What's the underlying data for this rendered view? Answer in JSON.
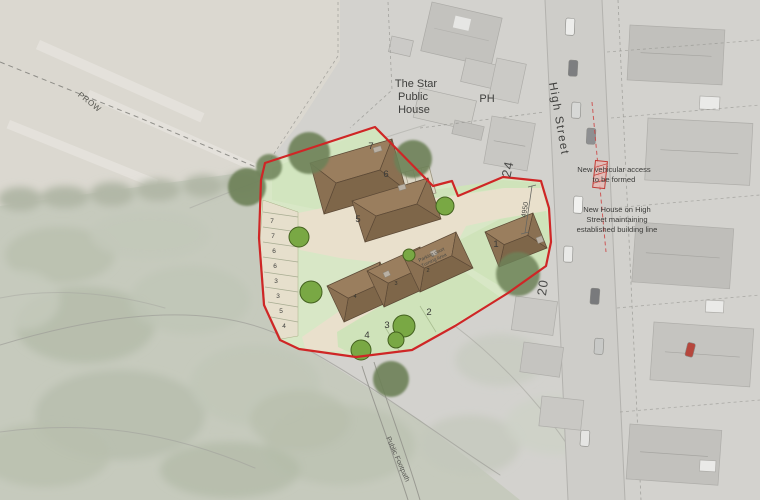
{
  "annotations": {
    "pub": [
      "The Star",
      "Public",
      "House"
    ],
    "ph": "PH",
    "street": "High Street",
    "prow": "PROW",
    "footpath": "Public Footpath",
    "access_note": [
      "New vehicular access",
      "to be formed"
    ],
    "house_note": [
      "New House on High",
      "Street maintaining",
      "established building line"
    ],
    "turning": [
      "Parking court",
      "Turning Area"
    ],
    "house_24": "24",
    "house_20": "20",
    "dimension": "4950"
  },
  "plots": {
    "p1": "1",
    "p2": "2",
    "p3": "3",
    "p4": "4",
    "p5": "5",
    "p6": "6",
    "p7": "7"
  },
  "roof_numbers": {
    "r2": "2",
    "r3": "3",
    "r4": "4"
  },
  "parking_bays": [
    "7",
    "7",
    "6",
    "6",
    "3",
    "3",
    "5",
    "4"
  ],
  "colors": {
    "boundary": "#cf2626",
    "roof": "#8c7153",
    "lawn": "#d8e7c6",
    "road_surface": "#e9e0cc",
    "tree_dark": "#6d8158",
    "tree_bright": "#79a844",
    "aerial_base": "#d3d2ce"
  }
}
